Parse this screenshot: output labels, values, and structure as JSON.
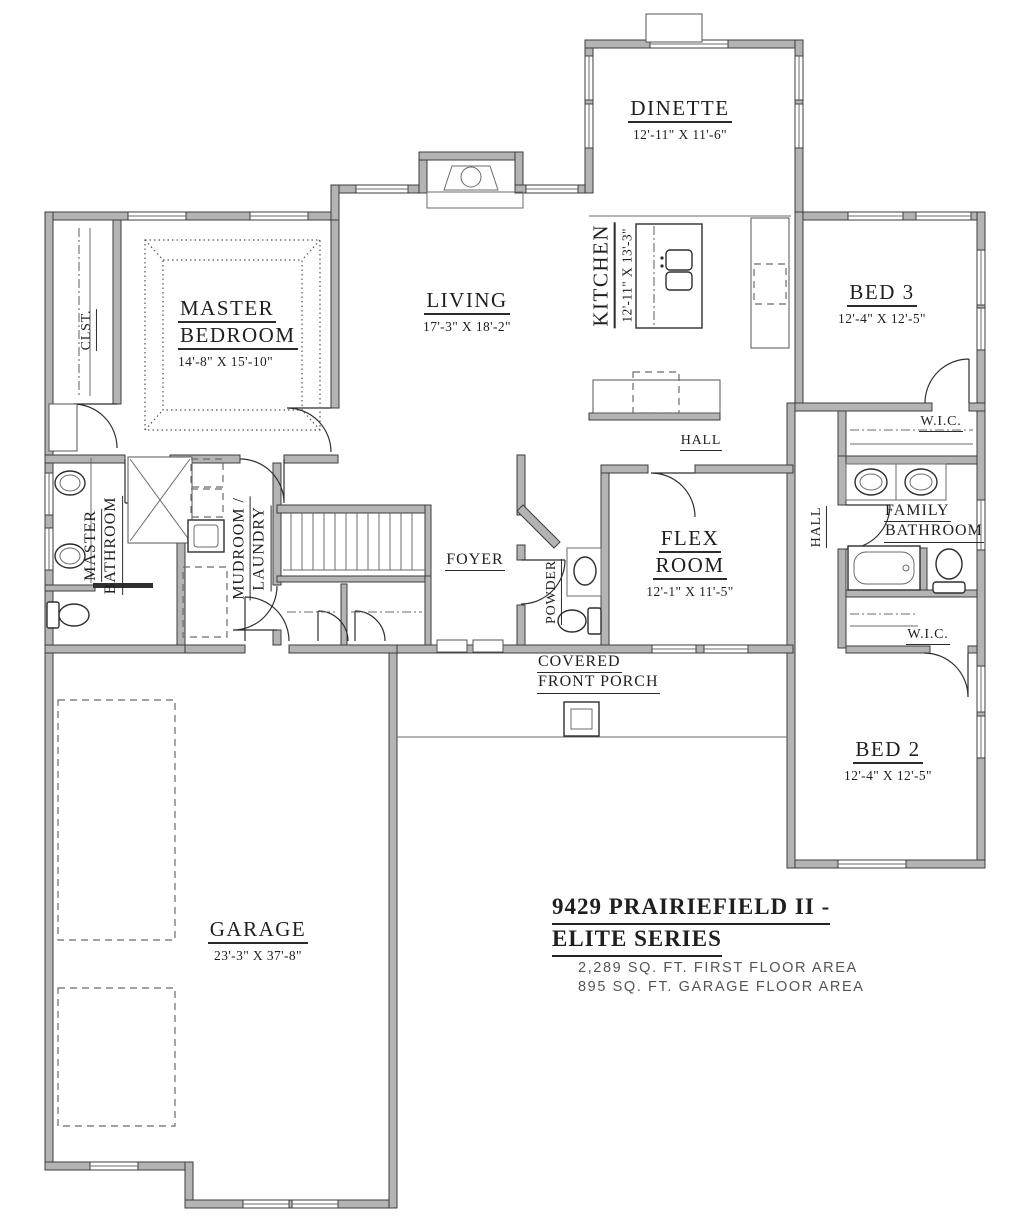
{
  "drawing": {
    "colors": {
      "wall_fill": "#b4b4b4",
      "wall_stroke": "#3d3d3d",
      "label_text": "#1f1f1f",
      "area_text": "#555555",
      "background": "#ffffff"
    },
    "labels": {
      "dinette": {
        "name": "DINETTE",
        "dims": "12'-11\" X 11'-6\""
      },
      "kitchen": {
        "name": "KITCHEN",
        "dims": "12'-11\" X 13'-3\""
      },
      "living": {
        "name": "LIVING",
        "dims": "17'-3\" X 18'-2\""
      },
      "master_bedroom": {
        "line1": "MASTER",
        "line2": "BEDROOM",
        "dims": "14'-8\" X 15'-10\""
      },
      "clst": {
        "name": "CLST."
      },
      "bed3": {
        "name": "BED 3",
        "dims": "12'-4\" X 12'-5\""
      },
      "wic_top": {
        "name": "W.I.C."
      },
      "hall_top": {
        "name": "HALL"
      },
      "hall_right": {
        "name": "HALL"
      },
      "family_bathroom": {
        "line1": "FAMILY",
        "line2": "BATHROOM"
      },
      "flex_room": {
        "line1": "FLEX",
        "line2": "ROOM",
        "dims": "12'-1\" X 11'-5\""
      },
      "master_bathroom": {
        "line1": "MASTER",
        "line2": "BATHROOM"
      },
      "mudroom_laundry": {
        "line1": "MUDROOM /",
        "line2": "LAUNDRY"
      },
      "foyer": {
        "name": "FOYER"
      },
      "powder": {
        "name": "POWDER"
      },
      "porch": {
        "line1": "COVERED",
        "line2": "FRONT PORCH"
      },
      "wic_bottom": {
        "name": "W.I.C."
      },
      "bed2": {
        "name": "BED 2",
        "dims": "12'-4\" X 12'-5\""
      },
      "garage": {
        "name": "GARAGE",
        "dims": "23'-3\" X 37'-8\""
      }
    },
    "title_block": {
      "title_line1": "9429 PRAIRIEFIELD II -",
      "title_line2": "ELITE SERIES",
      "area_line1": "2,289 SQ. FT. FIRST FLOOR AREA",
      "area_line2": "895 SQ. FT. GARAGE FLOOR AREA"
    }
  }
}
